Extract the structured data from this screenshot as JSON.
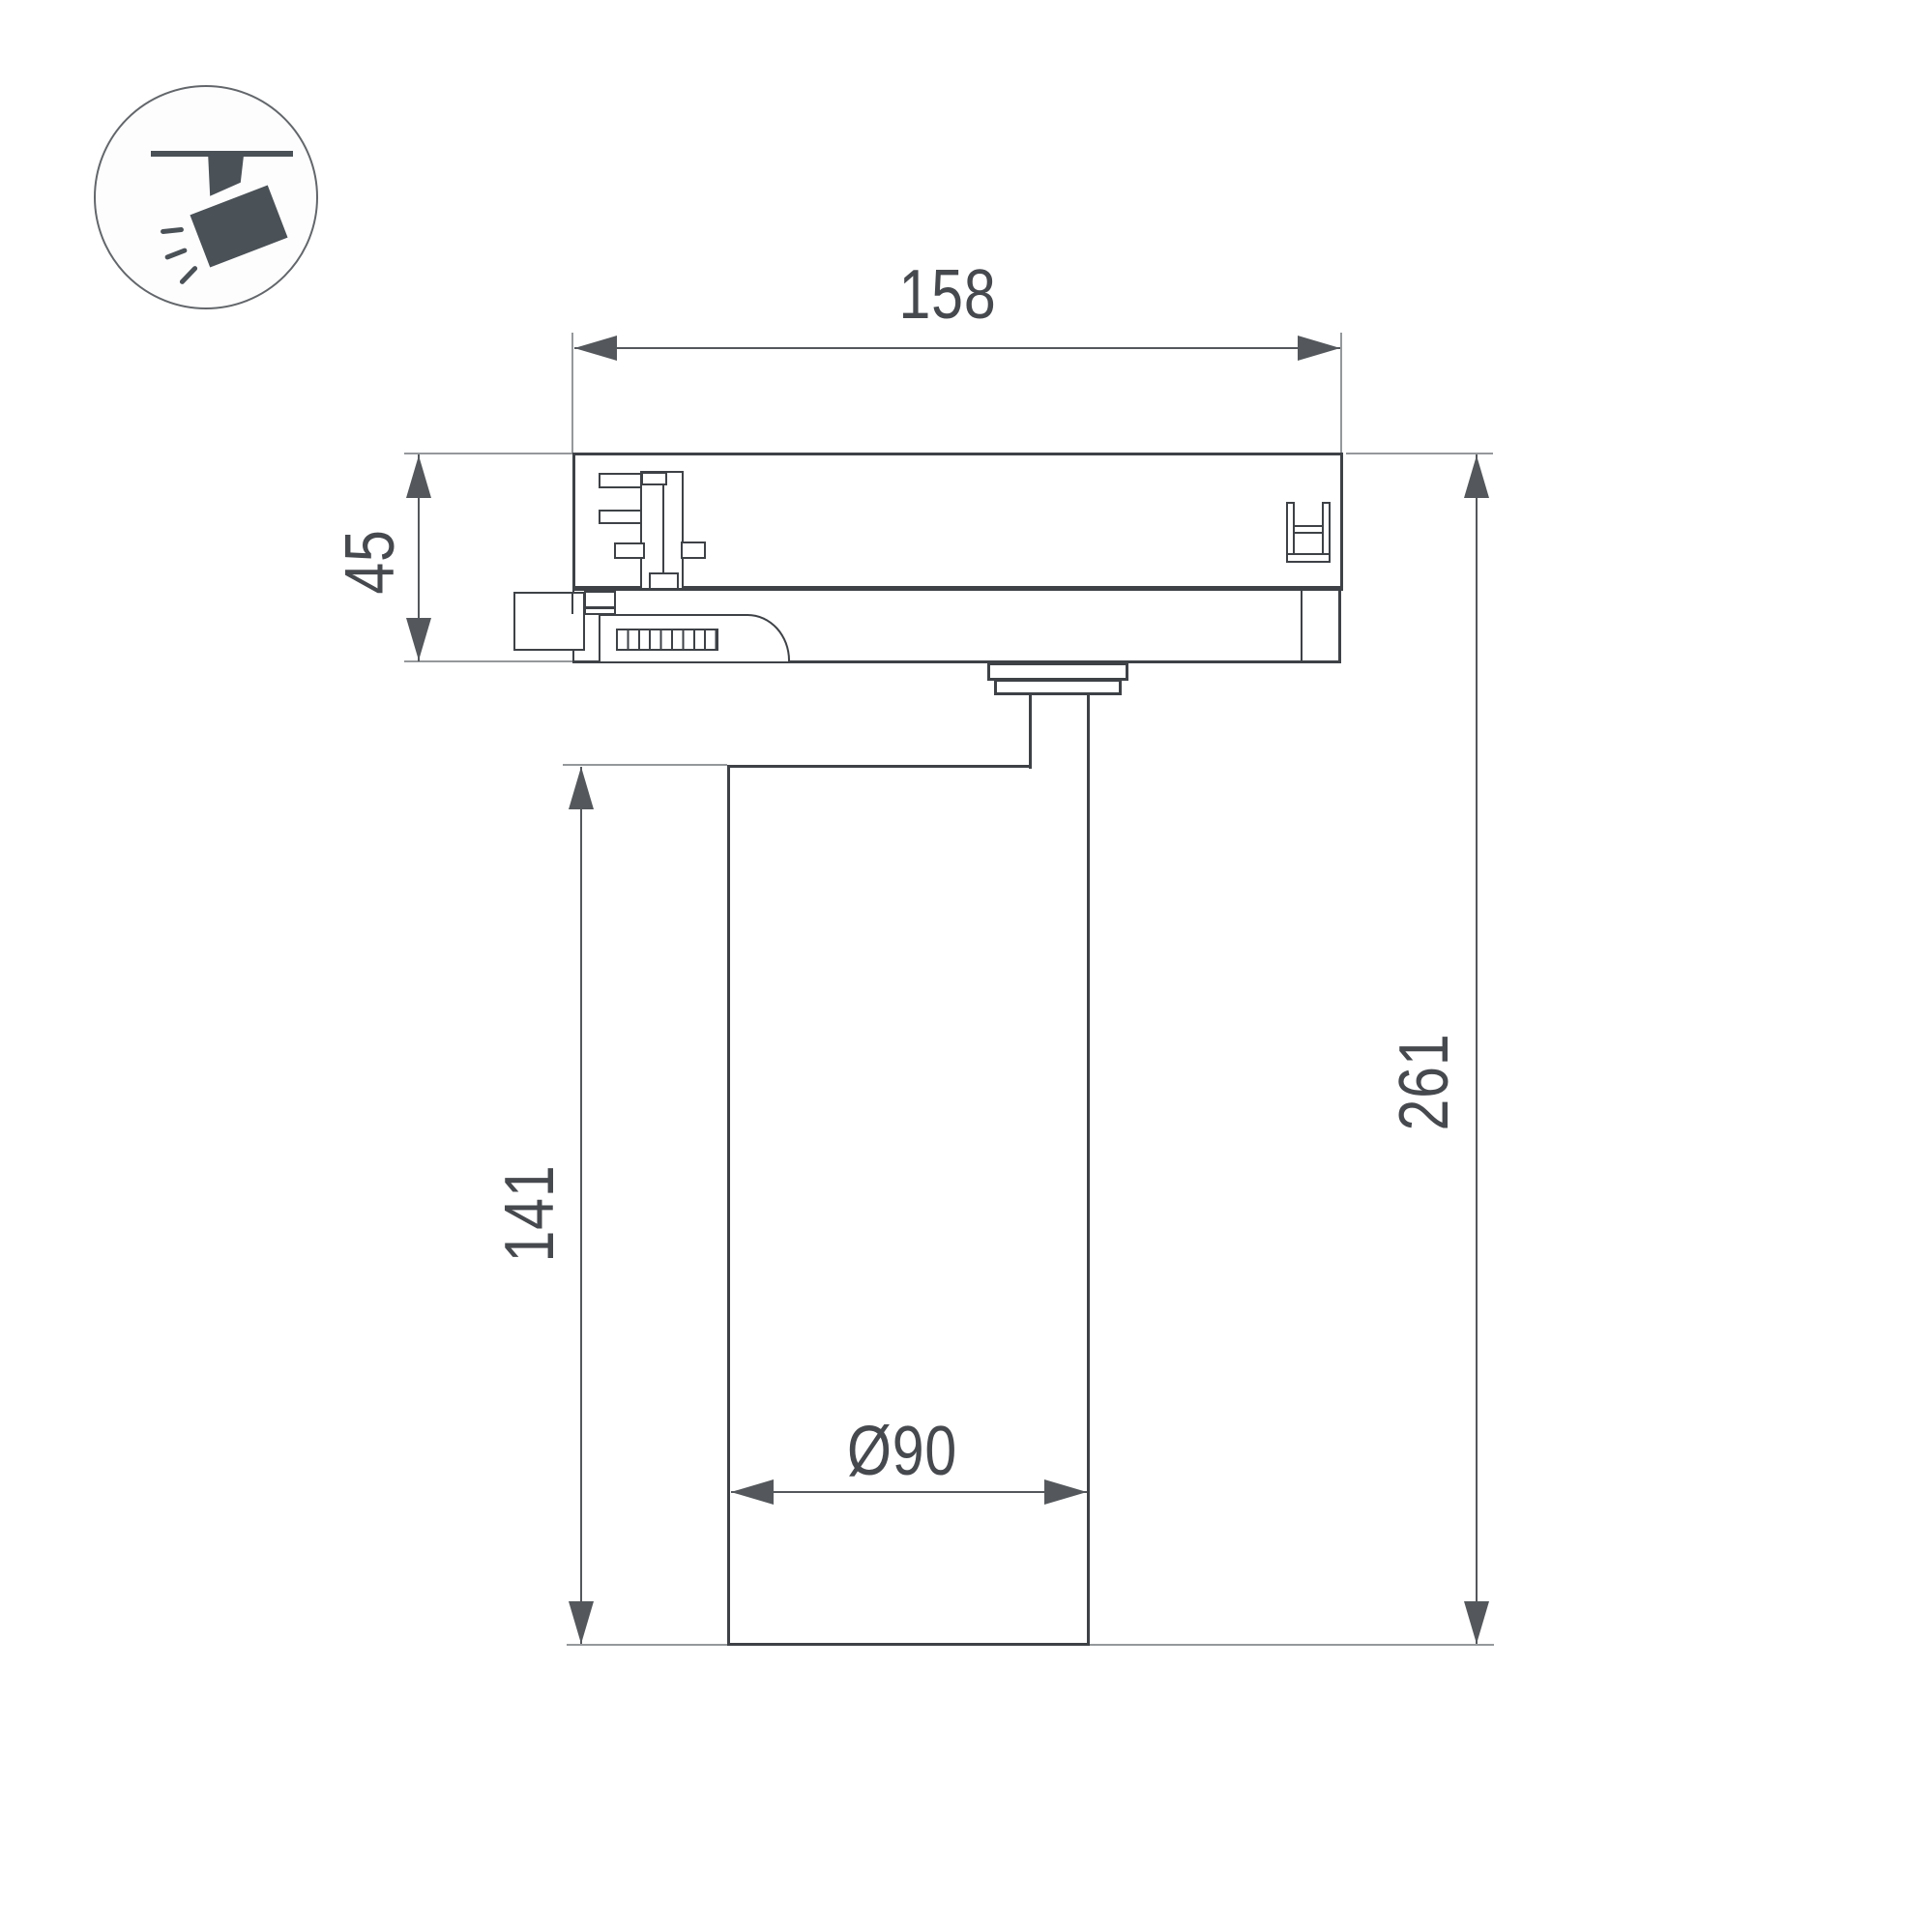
{
  "icon": {
    "name": "track-spotlight-icon"
  },
  "dimensions": {
    "top_width": "158",
    "adapter_height": "45",
    "body_height": "141",
    "total_height": "261",
    "body_diameter": "Ø90"
  },
  "colors": {
    "outline": "#3e4247",
    "dimension_line": "#54585c",
    "extension_line": "#95989b",
    "icon_glyph": "#4a5157",
    "background": "#ffffff"
  }
}
